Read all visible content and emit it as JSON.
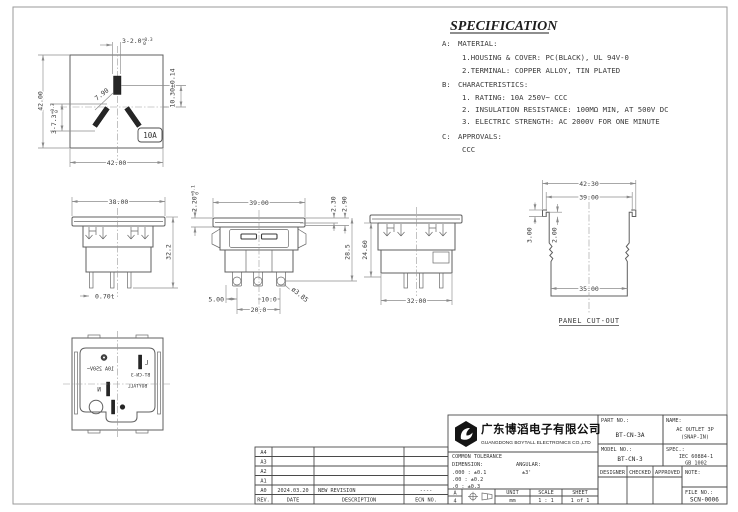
{
  "colors": {
    "object_line": "#5f5f5f",
    "dim_line": "#8b8b8b",
    "text": "#3b3b3b",
    "accent_dark": "#262626"
  },
  "spec": {
    "title": "SPECIFICATION",
    "a_label": "A:",
    "a_head": "MATERIAL:",
    "a1": "1.HOUSING & COVER: PC(BLACK), UL 94V-0",
    "a2": "2.TERMINAL: COPPER ALLOY, TIN PLATED",
    "b_label": "B:",
    "b_head": "CHARACTERISTICS:",
    "b1": "1. RATING: 10A 250V~ CCC",
    "b2": "2. INSULATION RESISTANCE: 100MΩ MIN, AT 500V DC",
    "b3": "3. ELECTRIC STRENGTH: AC 2000V FOR ONE MINUTE",
    "c_label": "C:",
    "c_head": "APPROVALS:",
    "c1": "CCC"
  },
  "views": {
    "front_face": {
      "slots_width_main": "3-2.0",
      "slots_width_sup": "+0.3",
      "slots_width_sub": "0",
      "earth_offset": "10.30±0.14",
      "overall_height": "42.00",
      "slots_length_main": "3-7.3",
      "slots_length_sup": "+0.3",
      "slots_length_sub": "0",
      "slot_angle_width": "7.90",
      "overall_width": "42.00",
      "rating_badge": "10A"
    },
    "side_a": {
      "width": "38.00",
      "height": "32.2",
      "terminal_thickness": "0.70t"
    },
    "front_b": {
      "cover_main": "2.20",
      "cover_sup": "+0.1",
      "cover_sub": "0",
      "width": "39.00",
      "step1": "2.30",
      "step2": "2.90",
      "height": "28.5",
      "hole_dia": "ø3.85",
      "pitch_a": "5.00",
      "pitch_b": "10.0",
      "pitch_c": "20.0"
    },
    "side_b": {
      "height": "24.60",
      "width": "32.00"
    },
    "panel_cutout": {
      "outer_width": "42.30",
      "inner_width": "39.00",
      "step_a": "3.00",
      "step_b": "2.00",
      "bottom_width": "35.00",
      "caption": "PANEL CUT-OUT"
    },
    "rear": {
      "rating": "10A 250V~",
      "line": "L",
      "neutral": "N",
      "brand": "BOYTALL",
      "model": "BT-CN-3"
    }
  },
  "title_block": {
    "company_cn": "广东博滔电子有限公司",
    "company_en": "GUANGDONG BOYTALL ELECTRONICS CO.,LTD",
    "part_no_label": "PART NO.:",
    "part_no": "BT-CN-3A",
    "name_label": "NAME:",
    "name1": "AC OUTLET 3P",
    "name2": "(SNAP-IN)",
    "model_no_label": "MODEL NO.:",
    "model_no": "BT-CN-3",
    "spec_label": "SPEC.:",
    "spec1": "IEC 60884-1",
    "spec2": "GB 1002",
    "designer": "DESIGNER",
    "checked": "CHECKED",
    "approved": "APPROVED",
    "note_label": "NOTE:",
    "file_no_label": "FILE NO.:",
    "file_no": "SCN-0006",
    "tol_title": "COMMON TOLERANCE",
    "dim_label": "DIMENSION:",
    "ang_label": "ANGULAR:",
    "tol1": ".000 : ±0.1",
    "tol2": ".00 : ±0.2",
    "tol3": ".0 : ±0.3",
    "ang_tol": "±3'",
    "size_a": "A",
    "size_4": "4",
    "unit_label": "UNIT",
    "unit": "mm",
    "scale_label": "SCALE",
    "scale": "1 : 1",
    "sheet_label": "SHEET",
    "sheet": "1 of 1"
  },
  "revisions": {
    "rows": [
      [
        "A4",
        "",
        "",
        ""
      ],
      [
        "A3",
        "",
        "",
        ""
      ],
      [
        "A2",
        "",
        "",
        ""
      ],
      [
        "A1",
        "",
        "",
        ""
      ],
      [
        "A0",
        "2024.03.20",
        "NEW REVISION",
        "----"
      ]
    ],
    "footer": [
      "REV.",
      "DATE",
      "DESCRIPTION",
      "ECN NO."
    ]
  }
}
